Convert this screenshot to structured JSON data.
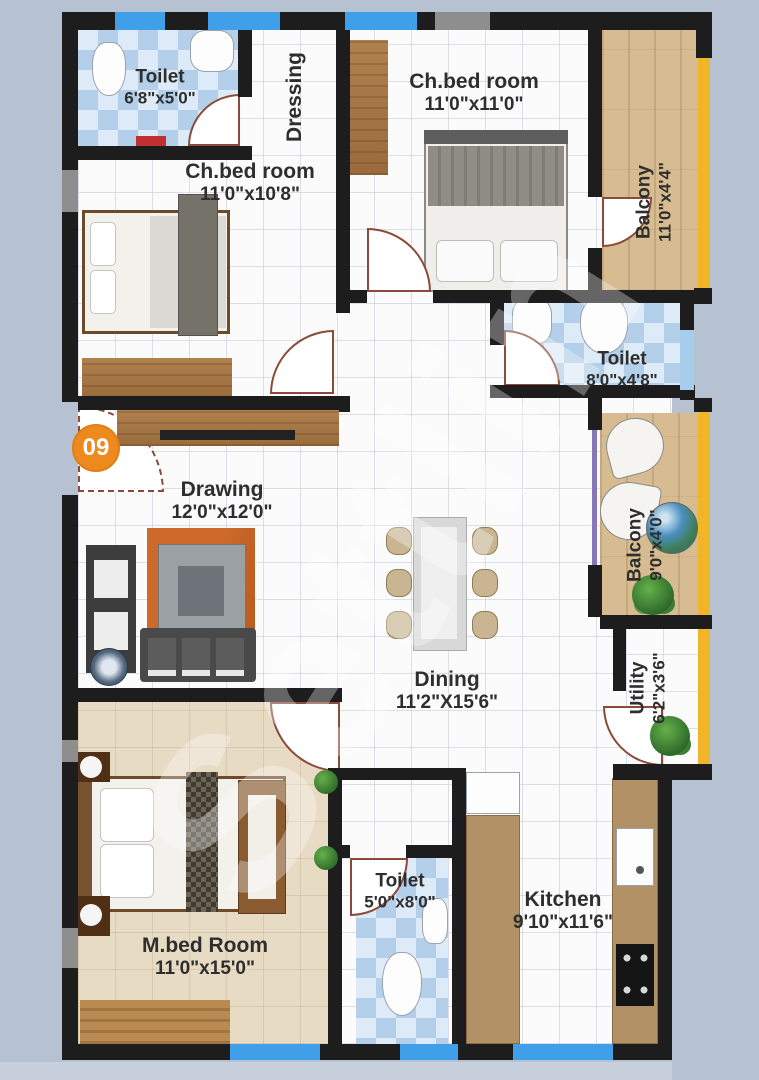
{
  "badge": {
    "number": "09"
  },
  "watermark": {
    "text": "Settlin"
  },
  "rooms": {
    "toilet1": {
      "name": "Toilet",
      "dims": "6'8\"x5'0\""
    },
    "dressing": {
      "name": "Dressing"
    },
    "chbed1": {
      "name": "Ch.bed room",
      "dims": "11'0\"x10'8\""
    },
    "chbed2": {
      "name": "Ch.bed room",
      "dims": "11'0\"x11'0\""
    },
    "balcony1": {
      "name": "Balcony",
      "dims": "11'0\"x4'4\""
    },
    "toilet2": {
      "name": "Toilet",
      "dims": "8'0\"x4'8\""
    },
    "balcony2": {
      "name": "Balcony",
      "dims": "9'0\"x4'0\""
    },
    "utility": {
      "name": "Utility",
      "dims": "6'2\"x3'6\""
    },
    "drawing": {
      "name": "Drawing",
      "dims": "12'0\"x12'0\""
    },
    "dining": {
      "name": "Dining",
      "dims": "11'2\"X15'6\""
    },
    "mbed": {
      "name": "M.bed Room",
      "dims": "11'0\"x15'0\""
    },
    "toilet3": {
      "name": "Toilet",
      "dims": "5'0\"x8'0\""
    },
    "kitchen": {
      "name": "Kitchen",
      "dims": "9'10\"x11'6\""
    }
  },
  "colors": {
    "background": "#b6c1d1",
    "wall": "#1d1d1d",
    "window_blue": "#3f9fe8",
    "balcony_edge_yellow": "#f0b528",
    "badge_orange": "#ee8a1d",
    "toilet_tile_blue": "#b3cfe9",
    "balcony_floor_tan": "#d7bc92",
    "mbed_floor_beige": "#e8dbc4",
    "door_arc_brown": "#8b4a3a"
  }
}
